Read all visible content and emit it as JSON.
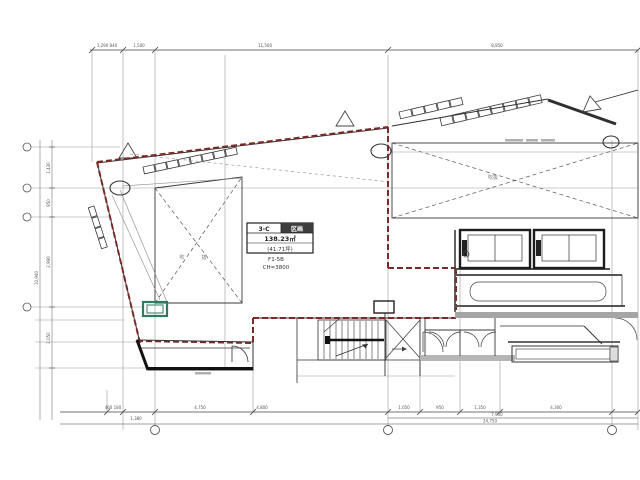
{
  "room_info": {
    "unit_left": "3-C",
    "unit_right": "区画",
    "area_m2": "138.23㎡",
    "area_tsubo": "(41.71坪)",
    "code": "F1-5B",
    "ceiling_height": "CH=3800"
  },
  "annotations": {
    "void_left": "吹　抜",
    "void_right": "吹抜"
  },
  "dimensions": {
    "top": [
      {
        "label": "1,290 840"
      },
      {
        "label": "1,500"
      },
      {
        "label": "11,500"
      },
      {
        "label": "8,850"
      }
    ],
    "left": [
      {
        "label": "1,430"
      },
      {
        "label": "950"
      },
      {
        "label": "2,990"
      },
      {
        "label": "2,050"
      }
    ],
    "left_total": "10,940",
    "bottom": [
      {
        "label": "460 180"
      },
      {
        "label": "1,380"
      },
      {
        "label": "4,750"
      },
      {
        "label": "4,800"
      },
      {
        "label": "1,050"
      },
      {
        "label": "950"
      },
      {
        "label": "1,350"
      },
      {
        "label": "4,300"
      }
    ],
    "bottom_subtotal": "7,950",
    "bottom_total": "24,750"
  },
  "colors": {
    "lease_boundary": "#7b2b26",
    "highlight_green": "#2f7a63",
    "line": "#2f2f2f",
    "grid": "#9a9a9a"
  }
}
